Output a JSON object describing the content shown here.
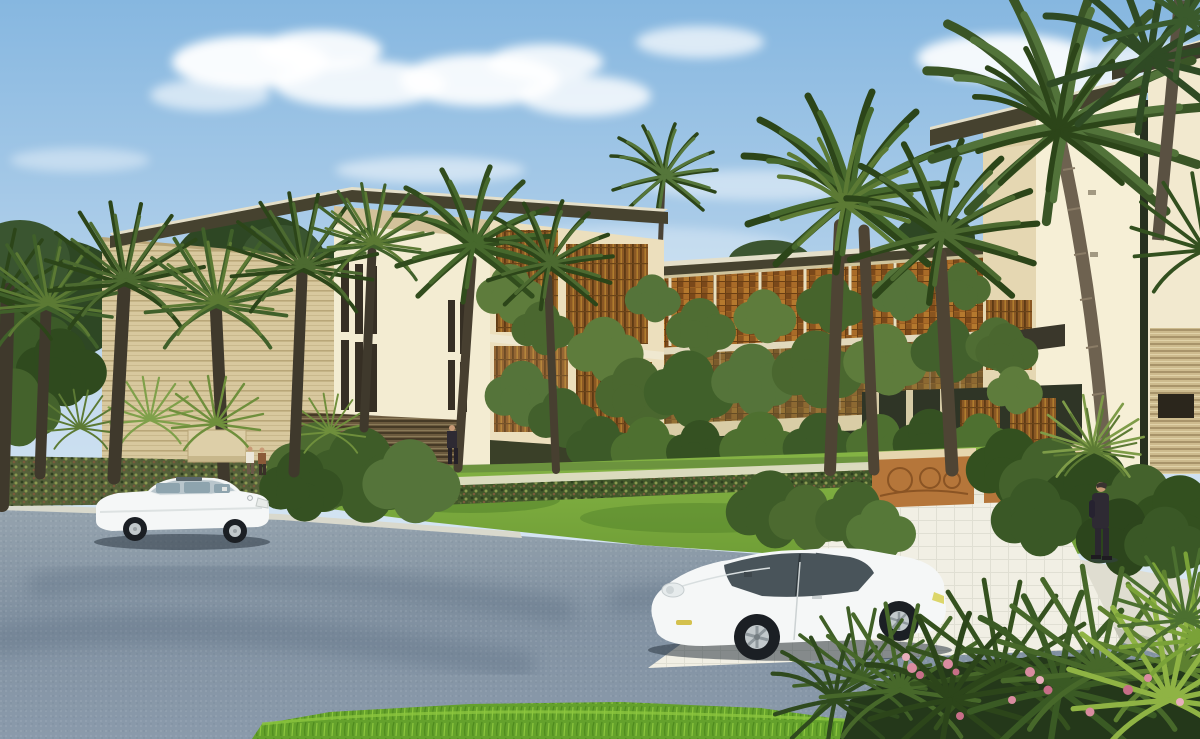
{
  "meta": {
    "title": "Tropical residential complex - architectural rendering",
    "type": "3d-architectural-render",
    "time_of_day": "day",
    "width_px": 1200,
    "height_px": 739
  },
  "scene": {
    "description": "Daytime photoreal rendering of a modern low-rise tropical residential complex. Cream stucco volumes with deep flat roof overhangs, timber louver and lattice screens covered in climbing vines, clusters of palm trees, a green lawn with hedge rows, a paved entrance walkway flanked by carved copper-toned gate walls, a gray asphalt road in the foreground with a white sedan and a white sports coupe, four small human figures, and tropical plants with pink flowers in the lower-right corner under a blue sky with soft clouds.",
    "objects": [
      {
        "name": "sky",
        "description": "Light blue gradient sky with soft white cumulus clouds"
      },
      {
        "name": "left-building",
        "description": "Three-storey cream block with large cantilevered flat roof, vertical slit windows, striped stone wall, timber louver panels"
      },
      {
        "name": "middle-wing",
        "description": "Two-storey wing with orange-brown lattice screens and heavy vine growth over an open ground colonnade"
      },
      {
        "name": "right-tower",
        "description": "Tall cream corner tower with dark flat roof and recessed entrance"
      },
      {
        "name": "right-edge-building",
        "description": "Pale building at right edge with tan horizontal-slat wall and dark slot window"
      },
      {
        "name": "palm-trees",
        "description": "Spiky palms at left, arching date palms at center, large leaning coconut palm at right"
      },
      {
        "name": "lawn",
        "description": "Bright green lawn with hedge row and footpath"
      },
      {
        "name": "entrance-walkway",
        "description": "Light paved walkway with grid paving flanked by two carved copper gate walls"
      },
      {
        "name": "road",
        "description": "Gray-blue speckled asphalt road in foreground"
      },
      {
        "name": "sedan-car",
        "description": "White luxury sedan parked at left, facing right"
      },
      {
        "name": "coupe-car",
        "description": "White sports coupe in center foreground, facing left"
      },
      {
        "name": "pedestrians",
        "description": "Two people near left shrubs, one suited figure at building base, one suited man on right sidewalk"
      },
      {
        "name": "foreground-plants",
        "description": "Palm fronds and pink flowering shrubs in bottom-right corner, grass strip along bottom"
      }
    ],
    "counts": {
      "cars": 2,
      "people": 4,
      "palm_tree_crowns": 14,
      "gate_walls": 2
    },
    "weather": "sunny"
  },
  "palette": {
    "sky_top": "#86b7e0",
    "sky_mid": "#c6dcef",
    "sky_low": "#eaf2f8",
    "cloud": "#ffffff",
    "wall_lit": "#f3ecd2",
    "wall_shade": "#e5d7b2",
    "wall_warm": "#ecdfbd",
    "wall_back": "#cfc49c",
    "wall_front": "#f6efd6",
    "stripe_base": "#d8c89e",
    "stripe_line": "#b9a678",
    "roof_dark": "#46422f",
    "roof_light": "#e4dfc9",
    "window_dark": "#362f24",
    "louver": "#8a5824",
    "louver_dark": "#5e3a14",
    "louver_light": "#b5812f",
    "lattice": "#9a5f22",
    "vine": "#55743a",
    "vine_dark": "#3c5a28",
    "vine_light": "#6e8d44",
    "palm": "#46682c",
    "palm_dark": "#2c4519",
    "palm_light": "#6f8f3c",
    "trunk": "#3f392c",
    "trunk_gray": "#6e6250",
    "lawn": "#86b545",
    "lawn_dark": "#6f9e36",
    "hedge": "#4a5a32",
    "road_top": "#95a3ae",
    "road_low": "#8191a1",
    "sidewalk": "#dfddd0",
    "paver": "#eceadb",
    "gate_wall": "#b5763a",
    "gate_relief": "#8a5424",
    "car_white": "#f5f7f7",
    "glass": "#49545a",
    "tire": "#1b1f24",
    "rim": "#c2c9cc",
    "shadow": "#2b3642",
    "skin": "#c89a76",
    "suit": "#2e2a33",
    "flower": "#d98ca0",
    "flower_dark": "#c76f88",
    "grass": "#64a12c",
    "grass_light": "#8cc63e"
  }
}
